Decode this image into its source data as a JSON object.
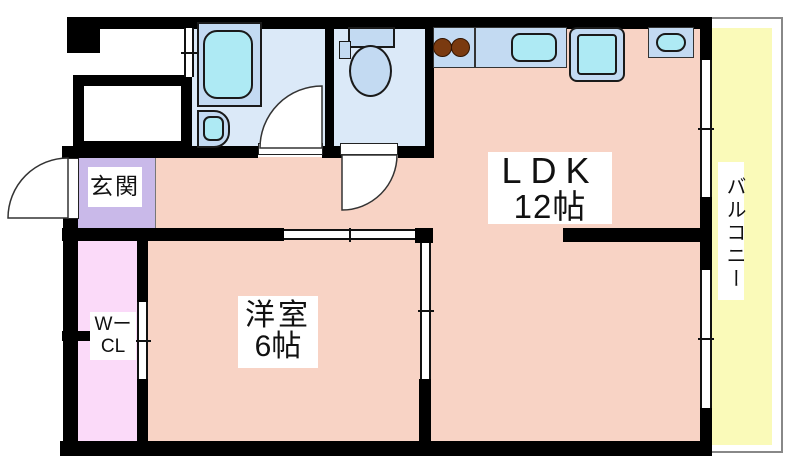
{
  "plan": {
    "rooms": {
      "ldk": {
        "name": "LDK",
        "size": "12帖"
      },
      "western_room": {
        "name": "洋室",
        "size": "6帖"
      },
      "entrance": {
        "name": "玄関"
      },
      "walk_in_closet": {
        "line1": "Wー",
        "line2": "CL"
      },
      "balcony": {
        "name": "バルコニー"
      }
    },
    "fixtures": [
      "bathtub",
      "wash-basin",
      "toilet",
      "stove-burners",
      "kitchen-sink",
      "kitchen-island-sink",
      "washer-pan"
    ],
    "colors": {
      "wall": "#000000",
      "room_salmon": "#f8d3c5",
      "entrance_lavender": "#c9b9e9",
      "closet_pink": "#fbdaf9",
      "balcony_yellow": "#fafab9",
      "bath_floor": "#dbe9f8",
      "fixture_blue": "#c3daf2",
      "water_cyan": "#aeeaf4",
      "burner_brown": "#7a3a10",
      "outline_gray": "#888888"
    }
  }
}
